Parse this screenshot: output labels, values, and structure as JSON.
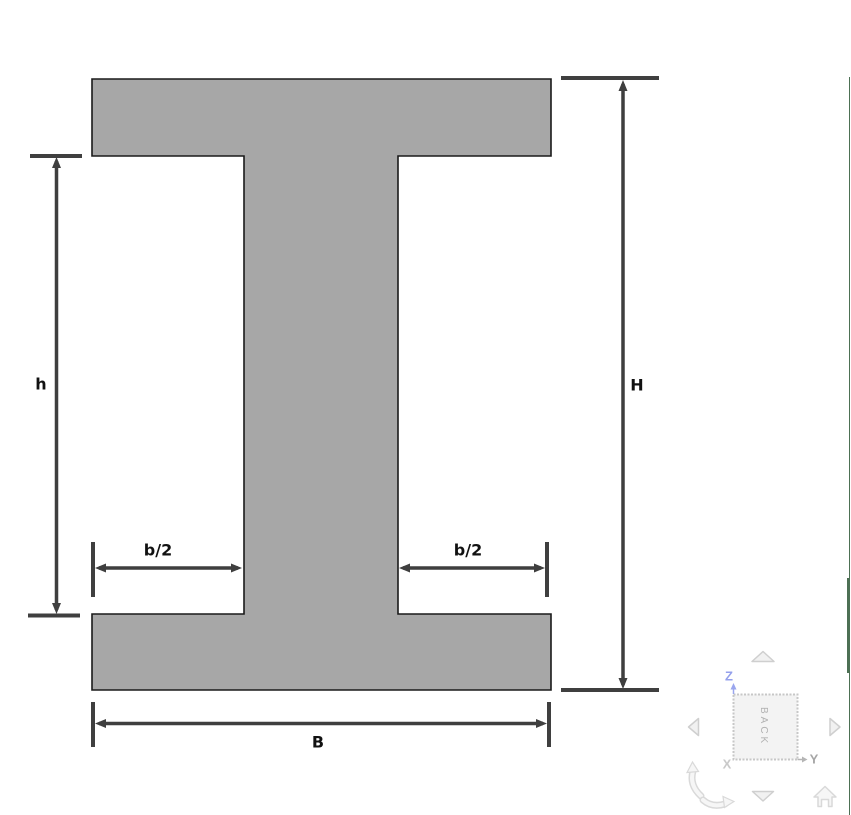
{
  "diagram": {
    "labels": {
      "h": "h",
      "H": "H",
      "b2_left": "b/2",
      "b2_right": "b/2",
      "B": "B"
    },
    "colors": {
      "beam_fill": "#a7a7a7",
      "beam_outline": "#1a1a1a",
      "dimension_line": "#3f3f3f",
      "label_text": "#111111"
    }
  },
  "view_navigator": {
    "face_label": "BACK",
    "axis_labels": {
      "z": "Z",
      "y": "Y",
      "x": "X"
    },
    "colors": {
      "z_axis": "#94a0ec",
      "y_axis": "#a6a6a6",
      "x_axis": "#c9c9c9",
      "control_outline": "#d2d2d2",
      "control_fill": "#f3f3f3",
      "face_text": "#b2b2b2"
    }
  },
  "scrollbar": {
    "color": "#4d7054"
  }
}
